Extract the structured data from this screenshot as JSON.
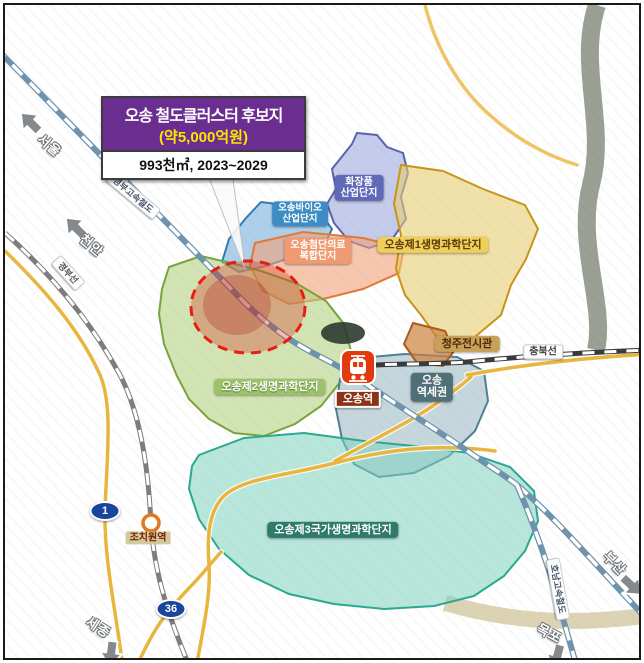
{
  "callout": {
    "title": "오송 철도클러스터 후보지",
    "amount": "(약5,000억원)",
    "spec": "993천㎡, 2023~2029"
  },
  "zones": {
    "cosmetic": {
      "line1": "화장품",
      "line2": "산업단지",
      "fill": "#96a0d8"
    },
    "bio": {
      "line1": "오송바이오",
      "line2": "산업단지",
      "fill": "#78afdc"
    },
    "medical": {
      "line1": "오송첨단의료",
      "line2": "복합단지",
      "fill": "#f2a078"
    },
    "life1": {
      "label": "오송제1생명과학단지",
      "fill": "#e6cd73"
    },
    "exhibition": {
      "label": "청주전시관",
      "fill": "#cd823c"
    },
    "life2": {
      "label": "오송제2생명과학단지",
      "fill": "#b4d287"
    },
    "station_area": {
      "line1": "오송",
      "line2": "역세권",
      "fill": "#8cafbb"
    },
    "life3": {
      "label": "오송제3국가생명과학단지",
      "fill": "#7dd2c2"
    }
  },
  "stations": {
    "osong": {
      "label": "오송역"
    },
    "jochiwon": {
      "label": "조치원역"
    }
  },
  "rail_labels": {
    "gyeongbu_ktx": "경부고속철도",
    "gyeongbu_line": "경부선",
    "chungbuk_line": "충북선",
    "honam_ktx": "호남고속철도"
  },
  "direction_signs": {
    "seoul": "서울",
    "cheonan": "천안",
    "sejong": "세종",
    "busan": "부산",
    "mokpo": "목포"
  },
  "route_badges": {
    "route1": "1",
    "route36": "36"
  },
  "colors": {
    "callout_purple": "#6a2d90",
    "callout_amount_yellow": "#ffe400",
    "candidate_site_red": "#e51f10",
    "ktx_rail_blue": "#6f93ad",
    "road_yellow": "#e8b63f"
  }
}
